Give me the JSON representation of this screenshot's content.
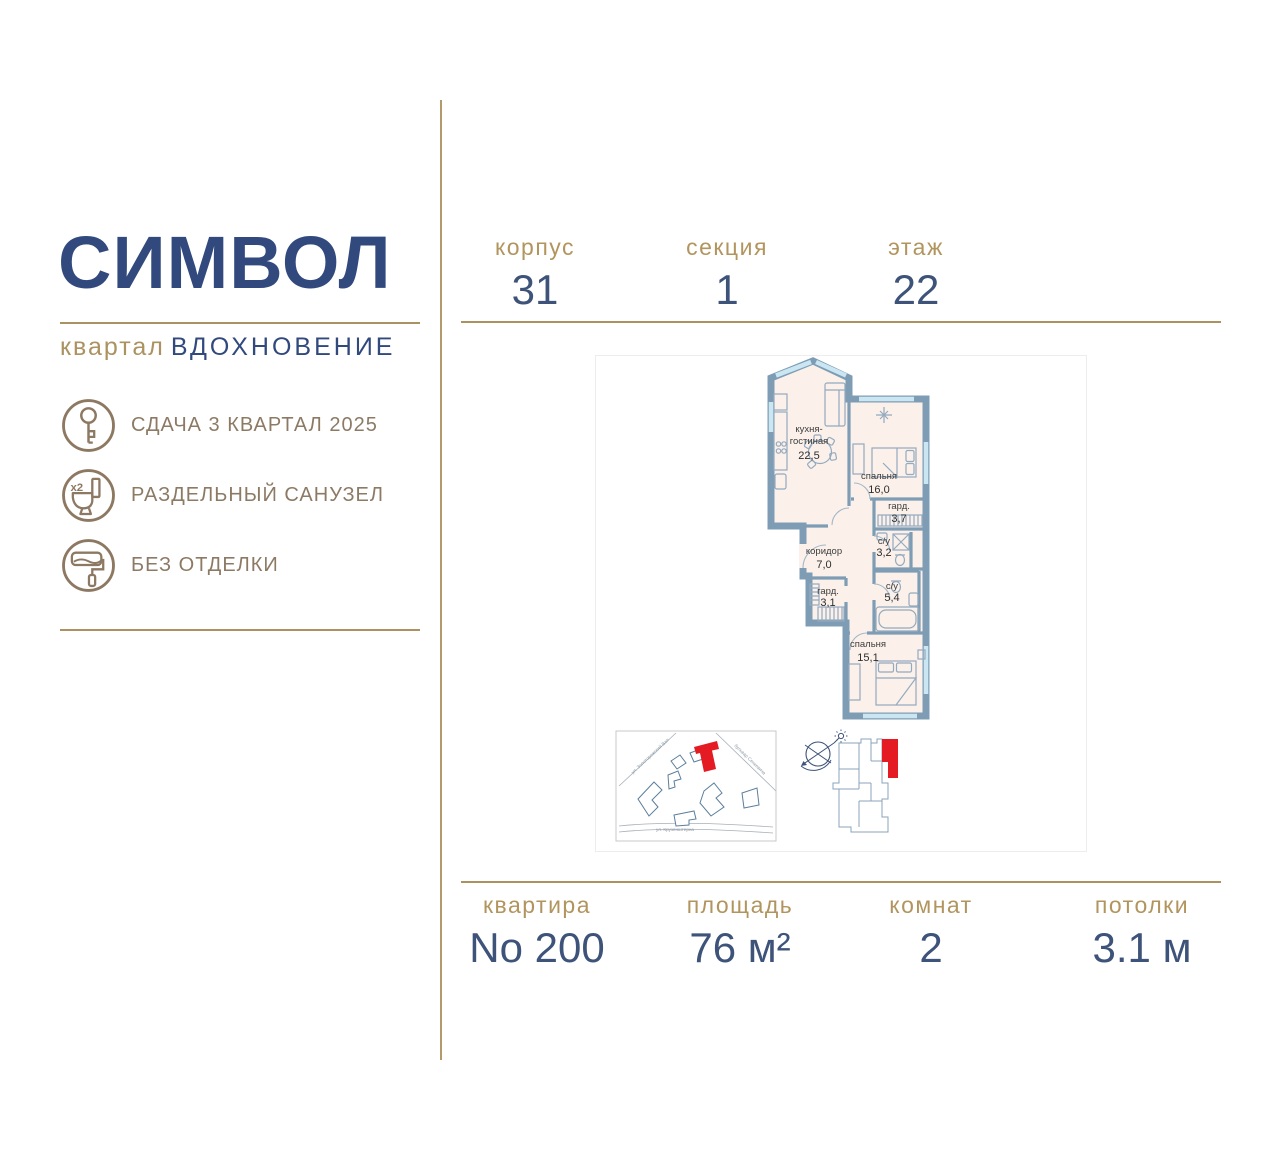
{
  "logo": {
    "title": "СИМВОЛ",
    "subtitle_prefix": "квартал",
    "subtitle": "ВДОХНОВЕНИЕ"
  },
  "features": [
    {
      "icon": "key-icon",
      "label": "СДАЧА 3 КВАРТАЛ 2025"
    },
    {
      "icon": "toilet-icon",
      "label": "РАЗДЕЛЬНЫЙ САНУЗЕЛ",
      "badge": "x2"
    },
    {
      "icon": "paint-roller-icon",
      "label": "БЕЗ ОТДЕЛКИ"
    }
  ],
  "building_info": {
    "korpus": {
      "label": "корпус",
      "value": "31"
    },
    "sektsiya": {
      "label": "секция",
      "value": "1"
    },
    "etazh": {
      "label": "этаж",
      "value": "22"
    }
  },
  "apartment_info": {
    "kvartira": {
      "label": "квартира",
      "value": "No 200"
    },
    "ploshchad": {
      "label": "площадь",
      "value": "76 м²"
    },
    "komnat": {
      "label": "комнат",
      "value": "2"
    },
    "potolki": {
      "label": "потолки",
      "value": "3.1 м"
    }
  },
  "plan": {
    "rooms": {
      "kitchen": {
        "name_line1": "кухня-",
        "name_line2": "гостиная",
        "area": "22,5"
      },
      "bedroom1": {
        "name": "спальня",
        "area": "16,0"
      },
      "wardrobe1": {
        "name": "гард.",
        "area": "3,7"
      },
      "bath1": {
        "name": "с/у",
        "area": "3,2"
      },
      "corridor": {
        "name": "коридор",
        "area": "7,0"
      },
      "wardrobe2": {
        "name": "гард.",
        "area": "3,1"
      },
      "bath2": {
        "name": "с/у",
        "area": "5,4"
      },
      "bedroom2": {
        "name": "спальня",
        "area": "15,1"
      }
    },
    "map_streets": {
      "street1": "ул. Золоторожский Вал",
      "street2": "бульвар Сенкевича",
      "street3": "ул. Крузенштерна"
    }
  },
  "colors": {
    "navy": "#32497e",
    "navy_value": "#3e5379",
    "gold": "#ab9260",
    "gold_label": "#b2955e",
    "icon_brown": "#8d7862",
    "wall_blue": "#7e9db5",
    "floor_cream": "#fbf1ea",
    "window_blue": "#cbe6f3",
    "highlight_red": "#e41b23"
  }
}
